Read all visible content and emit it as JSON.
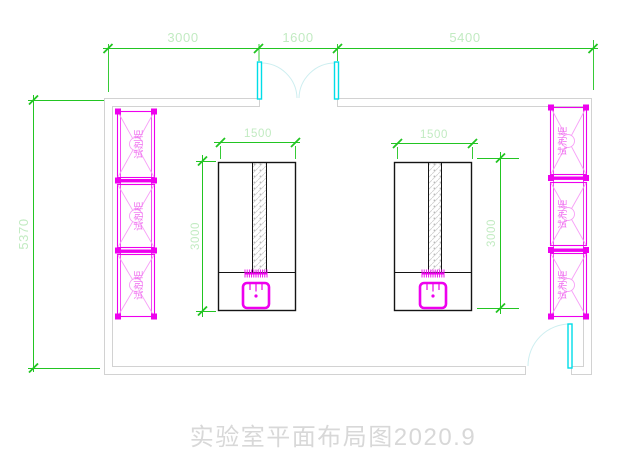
{
  "title": {
    "text": "实验室平面布局图2020.9"
  },
  "dimensions": {
    "top_segments": [
      "3000",
      "1600",
      "5400"
    ],
    "room_height": "5370"
  },
  "benches": {
    "left": {
      "width": "1500",
      "depth": "3000"
    },
    "right": {
      "width": "1500",
      "depth": "3000"
    }
  },
  "cabinet": {
    "label": "试剂柜"
  },
  "colors": {
    "dimension_line": "#22c522",
    "dimension_text": "#c2ebc2",
    "wall": "#d2d2d2",
    "cabinet": "#ee00ee",
    "cabinet_light": "#f7a0f7",
    "door_panel": "#00dde8",
    "door_arc": "#cdeef0",
    "bench_outline": "#141414",
    "title_text": "#d8d8d8"
  }
}
